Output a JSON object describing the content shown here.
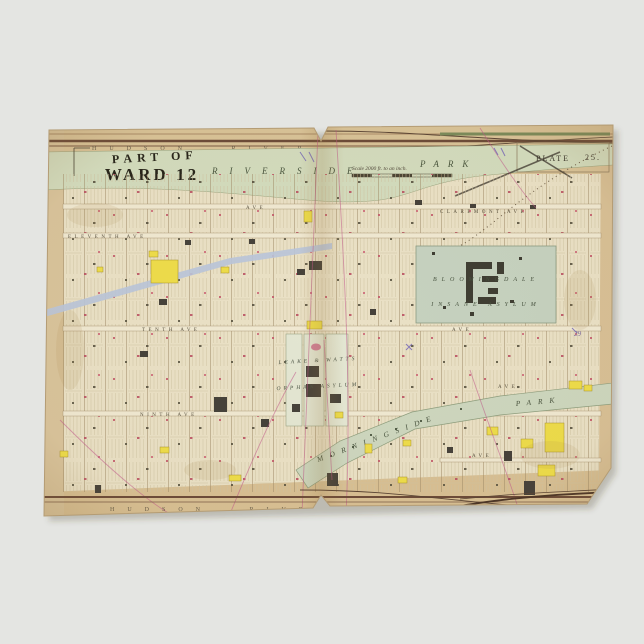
{
  "product": {
    "background_color": "#e4e5e2",
    "description": "antique atlas plate, Ward 12 Manhattan"
  },
  "map": {
    "title": {
      "line1": "PART OF",
      "line2": "WARD 12"
    },
    "scale_note": "Scale 2000 ft. to an inch.",
    "plate": {
      "label": "PLATE",
      "number": "25."
    },
    "top_band": "HUDSON RIVER",
    "bottom_band": "HUDSON RIVER",
    "riverside_park": {
      "word1": "RIVERSIDE",
      "word2": "PARK"
    },
    "morningside_park": {
      "word1": "MORNINGSIDE",
      "word2": "PARK"
    },
    "bloomingdale": {
      "line1": "BLOOMINGDALE",
      "line2": "INSANE ASYLUM"
    },
    "leake_watts": {
      "line1": "LEAKE & WATTS",
      "line2": "ORPHAN ASYLUM"
    },
    "streets": {
      "claremont": "CLAREMONT AVE",
      "eleventh": "ELEVENTH AVE",
      "tenth": "TENTH AVE",
      "ninth": "NINTH AVE",
      "ave_snippet": "AVE"
    },
    "annotations": {
      "pencil_number": "29"
    },
    "colors": {
      "paper": "#eae1c6",
      "margin_tan": "#d8c094",
      "park_green": "#d3dcbe",
      "asylum_green": "#c6d2c0",
      "boulevard_blue": "#b9c5da",
      "building_yellow": "#eedd4a",
      "building_dark": "#45413a",
      "mark_pink": "#c25568",
      "line_magenta": "#c0568a",
      "ink": "#27251b"
    }
  }
}
